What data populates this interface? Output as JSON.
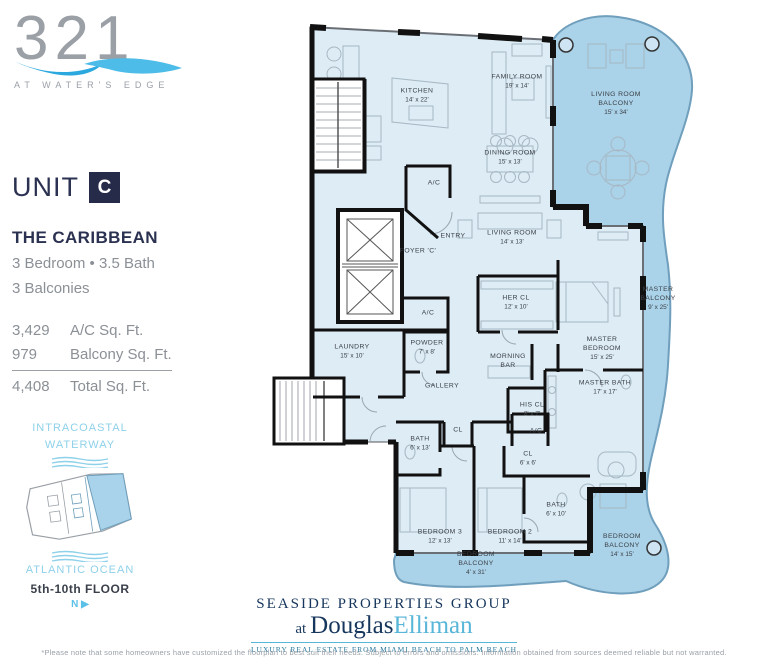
{
  "branding": {
    "logo_number": "321",
    "logo_tagline": "AT WATER'S EDGE"
  },
  "unit": {
    "label": "UNIT",
    "letter": "C",
    "model_name": "THE CARIBBEAN",
    "spec_beds_baths": "3 Bedroom •  3.5 Bath",
    "spec_balconies": "3 Balconies",
    "areas": [
      {
        "value": "3,429",
        "label": "A/C Sq. Ft."
      },
      {
        "value": "979",
        "label": "Balcony Sq. Ft."
      },
      {
        "value": "4,408",
        "label": "Total Sq. Ft."
      }
    ]
  },
  "keyplan": {
    "waterway_line1": "INTRACOASTAL",
    "waterway_line2": "WATERWAY",
    "ocean_label": "ATLANTIC OCEAN",
    "floor_label": "5th-10th FLOOR",
    "north_label": "N ▶",
    "highlight_color": "#a9d3ea"
  },
  "floorplan": {
    "interior_color": "#ddecf5",
    "balcony_color": "#aad2e8",
    "wall_color": "#111111",
    "rooms": [
      {
        "id": "kitchen",
        "name": "KITCHEN",
        "dims": "14' x 22'",
        "x": 417,
        "y": 96
      },
      {
        "id": "family-room",
        "name": "FAMILY ROOM",
        "dims": "19' x 14'",
        "x": 517,
        "y": 82
      },
      {
        "id": "living-room-balcony",
        "name": "LIVING ROOM\nBALCONY",
        "dims": "15' x 34'",
        "x": 616,
        "y": 104
      },
      {
        "id": "dining-room",
        "name": "DINING ROOM",
        "dims": "15' x 13'",
        "x": 510,
        "y": 158
      },
      {
        "id": "ac-upper",
        "name": "A/C",
        "dims": "",
        "x": 434,
        "y": 184
      },
      {
        "id": "entry",
        "name": "ENTRY",
        "dims": "",
        "x": 453,
        "y": 237
      },
      {
        "id": "living-room",
        "name": "LIVING ROOM",
        "dims": "14' x 13'",
        "x": 512,
        "y": 238
      },
      {
        "id": "foyer",
        "name": "FOYER 'C'",
        "dims": "",
        "x": 418,
        "y": 252
      },
      {
        "id": "her-cl",
        "name": "HER CL",
        "dims": "12' x 10'",
        "x": 516,
        "y": 303
      },
      {
        "id": "ac-lower",
        "name": "A/C",
        "dims": "",
        "x": 428,
        "y": 314
      },
      {
        "id": "master-bedroom",
        "name": "MASTER\nBEDROOM",
        "dims": "15' x 25'",
        "x": 602,
        "y": 349
      },
      {
        "id": "master-balcony",
        "name": "MASTER\nBALCONY",
        "dims": "9' x 25'",
        "x": 658,
        "y": 299
      },
      {
        "id": "laundry",
        "name": "LAUNDRY",
        "dims": "15' x 10'",
        "x": 352,
        "y": 352
      },
      {
        "id": "powder",
        "name": "POWDER",
        "dims": "7' x 8'",
        "x": 427,
        "y": 348
      },
      {
        "id": "morning-bar",
        "name": "MORNING\nBAR",
        "dims": "",
        "x": 508,
        "y": 362
      },
      {
        "id": "gallery",
        "name": "GALLERY",
        "dims": "",
        "x": 442,
        "y": 387
      },
      {
        "id": "master-bath",
        "name": "MASTER BATH",
        "dims": "17' x 17'",
        "x": 605,
        "y": 388
      },
      {
        "id": "his-cl",
        "name": "HIS CL",
        "dims": "8' x 7'",
        "x": 532,
        "y": 410
      },
      {
        "id": "cl-hall",
        "name": "CL",
        "dims": "",
        "x": 458,
        "y": 431
      },
      {
        "id": "ac-bed",
        "name": "A/C",
        "dims": "",
        "x": 536,
        "y": 432
      },
      {
        "id": "bath-3",
        "name": "BATH",
        "dims": "6' x 13'",
        "x": 420,
        "y": 444
      },
      {
        "id": "cl-bed2",
        "name": "CL",
        "dims": "6' x 6'",
        "x": 528,
        "y": 459
      },
      {
        "id": "bath-2",
        "name": "BATH",
        "dims": "6' x 10'",
        "x": 556,
        "y": 510
      },
      {
        "id": "bedroom-3",
        "name": "BEDROOM 3",
        "dims": "12' x 13'",
        "x": 440,
        "y": 537
      },
      {
        "id": "bedroom-2",
        "name": "BEDROOM 2",
        "dims": "11' x 14'",
        "x": 510,
        "y": 537
      },
      {
        "id": "bedroom-balcony-s",
        "name": "BEDROOM\nBALCONY",
        "dims": "4' x 31'",
        "x": 476,
        "y": 564
      },
      {
        "id": "bedroom-balcony-e",
        "name": "BEDROOM\nBALCONY",
        "dims": "14' x 15'",
        "x": 622,
        "y": 546
      }
    ]
  },
  "footer": {
    "brokerage_group": "SEASIDE PROPERTIES GROUP",
    "at_word": "at",
    "brand_first": "Douglas",
    "brand_second": "Elliman",
    "tagline": "LUXURY REAL ESTATE FROM MIAMI BEACH TO PALM BEACH",
    "disclaimer": "*Please note that some homeowners have customized the floorplan to best suit their needs. Subject to errors and omissions. Information obtained from sources deemed reliable but not warranted."
  }
}
